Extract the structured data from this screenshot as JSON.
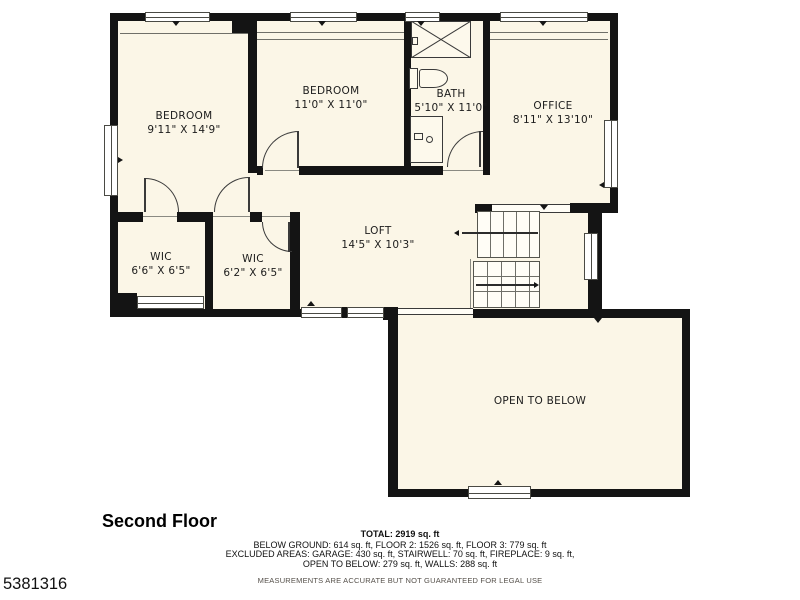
{
  "plan": {
    "title": "Second Floor",
    "listing_id": "5381316",
    "rooms": [
      {
        "name": "BEDROOM",
        "dims": "9'11\" X 14'9\""
      },
      {
        "name": "BEDROOM",
        "dims": "11'0\" X 11'0\""
      },
      {
        "name": "BATH",
        "dims": "5'10\" X 11'0\""
      },
      {
        "name": "OFFICE",
        "dims": "8'11\" X 13'10\""
      },
      {
        "name": "WIC",
        "dims": "6'6\" X 6'5\""
      },
      {
        "name": "WIC",
        "dims": "6'2\" X 6'5\""
      },
      {
        "name": "LOFT",
        "dims": "14'5\" X 10'3\""
      },
      {
        "name": "OPEN TO BELOW",
        "dims": ""
      }
    ],
    "summary": {
      "total": "TOTAL: 2919 sq. ft",
      "areas_line1": "BELOW GROUND: 614 sq. ft, FLOOR 2: 1526 sq. ft, FLOOR 3: 779 sq. ft",
      "areas_line2": "EXCLUDED AREAS: GARAGE: 430 sq. ft, STAIRWELL: 70 sq. ft, FIREPLACE: 9 sq. ft,",
      "areas_line3": "OPEN TO BELOW: 279 sq. ft, WALLS: 288 sq. ft",
      "disclaimer": "MEASUREMENTS ARE ACCURATE BUT NOT GUARANTEED FOR LEGAL USE"
    },
    "colors": {
      "floor": "#fbf6e7",
      "wall": "#141414",
      "line": "#3a3a3a"
    }
  }
}
